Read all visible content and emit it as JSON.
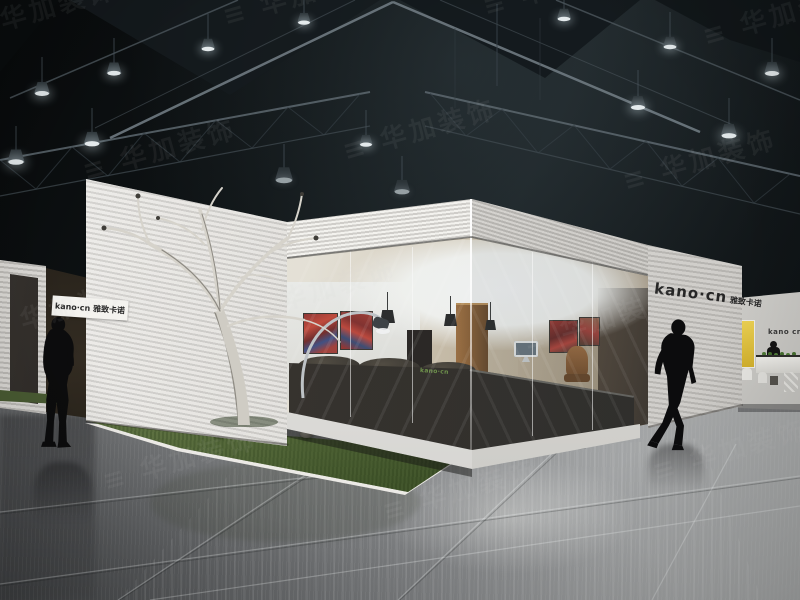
{
  "scene": {
    "description": "3D render of a white exhibition booth with a glass showroom corner in a dark exhibition hall",
    "hall": "dark steel truss ceiling with industrial pendant lights and a glossy grey reflective floor",
    "landscaping": "bare white tree on a grass bed with rocks in front of the booth"
  },
  "branding": {
    "latin": "kano·cn",
    "cjk": "雅致卡诺",
    "full": "kano·cn 雅致卡诺",
    "counter": "kano·cn",
    "distant": "kano cn"
  },
  "watermark": {
    "tile_text": "≡ 华加装饰"
  },
  "colors": {
    "booth_white": "#e6e4e0",
    "ceiling_black": "#0b0e10",
    "floor_grey": "#8f9193",
    "grass_green": "#53663b",
    "artwork_red": "#b03226",
    "accent_yellow": "#e3c23c",
    "counter_logo_green": "#6f9c3f",
    "silhouette_black": "#0c0c0d"
  },
  "objects": {
    "people_silhouettes": 3,
    "ceiling_lights": 14,
    "artworks": 4,
    "furniture": [
      "dark sofa",
      "reception counter",
      "desk with monitor",
      "office chair",
      "arc floor lamp",
      "pendant lamps",
      "visitor chairs"
    ]
  }
}
